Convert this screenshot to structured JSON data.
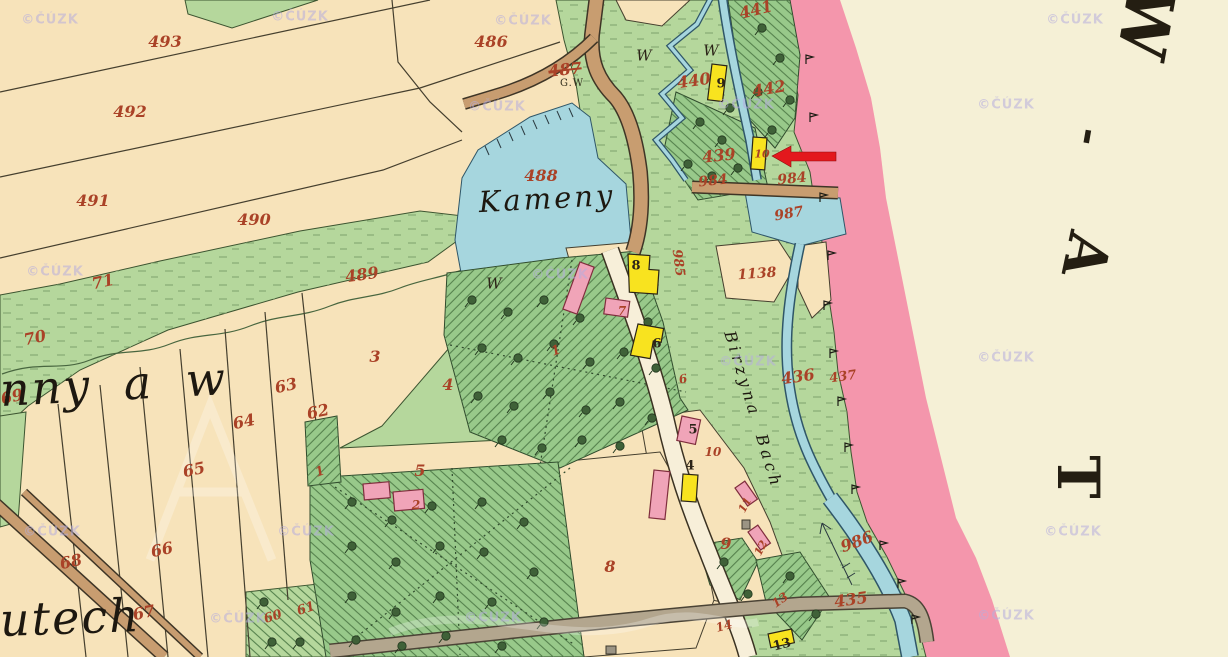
{
  "map": {
    "watermark_text": "©ČÚZK",
    "colors": {
      "field": "#f7e3ba",
      "paper": "#f5f0d6",
      "meadow": "#b5d79c",
      "forest": "#98c98a",
      "water": "#a6d6de",
      "wedge": "#2f5668",
      "pink": "#f496ac",
      "wood": "#f8e31f",
      "stone": "#f0a4b8",
      "red": "#aa4227",
      "wm": "#b6aede",
      "arrow": "#e3181d"
    },
    "labels": {
      "red": [
        {
          "t": "493",
          "x": 165,
          "y": 42
        },
        {
          "t": "492",
          "x": 130,
          "y": 112
        },
        {
          "t": "491",
          "x": 93,
          "y": 201
        },
        {
          "t": "490",
          "x": 254,
          "y": 220
        },
        {
          "t": "489",
          "x": 362,
          "y": 275,
          "r": -8
        },
        {
          "t": "71",
          "x": 103,
          "y": 282,
          "r": -12
        },
        {
          "t": "70",
          "x": 35,
          "y": 338,
          "r": -12
        },
        {
          "t": "69",
          "x": 12,
          "y": 397,
          "r": -12
        },
        {
          "t": "486",
          "x": 491,
          "y": 42
        },
        {
          "t": "487",
          "x": 565,
          "y": 70,
          "r": -6,
          "cls": "strike"
        },
        {
          "t": "488",
          "x": 541,
          "y": 176
        },
        {
          "t": "440",
          "x": 694,
          "y": 81,
          "r": -8
        },
        {
          "t": "441",
          "x": 756,
          "y": 10,
          "r": -14
        },
        {
          "t": "442",
          "x": 769,
          "y": 89,
          "r": -10
        },
        {
          "t": "439",
          "x": 719,
          "y": 156,
          "r": -6
        },
        {
          "t": "984",
          "x": 713,
          "y": 181,
          "r": -6,
          "s": 14
        },
        {
          "t": "984",
          "x": 792,
          "y": 179,
          "r": -6,
          "s": 14
        },
        {
          "t": "987",
          "x": 789,
          "y": 214,
          "r": -10,
          "s": 14
        },
        {
          "t": "1138",
          "x": 757,
          "y": 274,
          "r": -4,
          "s": 14
        },
        {
          "t": "985",
          "x": 678,
          "y": 263,
          "r": 82,
          "s": 13
        },
        {
          "t": "436",
          "x": 798,
          "y": 377,
          "r": -8
        },
        {
          "t": "437",
          "x": 843,
          "y": 377,
          "r": -8,
          "s": 13
        },
        {
          "t": "986",
          "x": 857,
          "y": 542,
          "r": -20
        },
        {
          "t": "435",
          "x": 851,
          "y": 600,
          "r": -8
        },
        {
          "t": "3",
          "x": 375,
          "y": 357
        },
        {
          "t": "4",
          "x": 448,
          "y": 385
        },
        {
          "t": "5",
          "x": 420,
          "y": 471
        },
        {
          "t": "63",
          "x": 286,
          "y": 386,
          "r": -12
        },
        {
          "t": "62",
          "x": 318,
          "y": 412,
          "r": -12
        },
        {
          "t": "64",
          "x": 244,
          "y": 422,
          "r": -12
        },
        {
          "t": "65",
          "x": 194,
          "y": 470,
          "r": -12
        },
        {
          "t": "66",
          "x": 162,
          "y": 550,
          "r": -12
        },
        {
          "t": "68",
          "x": 71,
          "y": 562,
          "r": -12
        },
        {
          "t": "67",
          "x": 144,
          "y": 613,
          "r": -12
        },
        {
          "t": "61",
          "x": 306,
          "y": 609,
          "r": -18,
          "s": 13
        },
        {
          "t": "60",
          "x": 273,
          "y": 617,
          "r": -18,
          "s": 13
        },
        {
          "t": "8",
          "x": 610,
          "y": 567
        },
        {
          "t": "9",
          "x": 726,
          "y": 544
        },
        {
          "t": "1",
          "x": 556,
          "y": 351,
          "r": -20,
          "s": 13
        },
        {
          "t": "1",
          "x": 320,
          "y": 472,
          "r": -20,
          "s": 13
        },
        {
          "t": "2",
          "x": 416,
          "y": 505,
          "s": 12
        },
        {
          "t": "7",
          "x": 622,
          "y": 311,
          "s": 12
        },
        {
          "t": "6",
          "x": 683,
          "y": 379,
          "r": -10,
          "s": 12
        },
        {
          "t": "10",
          "x": 762,
          "y": 154,
          "s": 11
        },
        {
          "t": "10",
          "x": 713,
          "y": 452,
          "s": 12
        },
        {
          "t": "11",
          "x": 745,
          "y": 505,
          "r": -62,
          "s": 11
        },
        {
          "t": "12",
          "x": 761,
          "y": 548,
          "r": -62,
          "s": 11
        },
        {
          "t": "13",
          "x": 780,
          "y": 600,
          "r": -35,
          "s": 12
        },
        {
          "t": "14",
          "x": 724,
          "y": 626,
          "r": -15,
          "s": 12
        }
      ],
      "black": [
        {
          "t": "9",
          "x": 721,
          "y": 84,
          "cls": "house",
          "n": "house-number"
        },
        {
          "t": "8",
          "x": 636,
          "y": 266,
          "cls": "house",
          "n": "house-number"
        },
        {
          "t": "6",
          "x": 657,
          "y": 344,
          "cls": "house",
          "n": "house-number"
        },
        {
          "t": "5",
          "x": 693,
          "y": 430,
          "cls": "house",
          "n": "house-number"
        },
        {
          "t": "4",
          "x": 690,
          "y": 466,
          "cls": "house",
          "n": "house-number"
        },
        {
          "t": "13",
          "x": 782,
          "y": 645,
          "r": -14,
          "cls": "house",
          "n": "house-number"
        },
        {
          "t": "W",
          "x": 644,
          "y": 56,
          "n": "meadow-mark"
        },
        {
          "t": "W",
          "x": 711,
          "y": 51,
          "n": "meadow-mark"
        },
        {
          "t": "W",
          "x": 494,
          "y": 284,
          "n": "meadow-mark"
        },
        {
          "t": "G.W",
          "x": 572,
          "y": 84,
          "cls": "gw",
          "n": "culture-abbr"
        },
        {
          "t": "Kameny",
          "x": 547,
          "y": 199,
          "r": -3,
          "cls": "pond-name",
          "n": "pond-label"
        },
        {
          "t": "Birzyna Bach",
          "x": 753,
          "y": 410,
          "r": 73,
          "cls": "stream-name",
          "n": "stream-label"
        },
        {
          "t": "nny a w",
          "x": 0,
          "y": 390,
          "r": -3,
          "cls": "bigscript",
          "n": "territory-script"
        },
        {
          "t": "utech",
          "x": 0,
          "y": 620,
          "r": -2,
          "cls": "bigscript",
          "n": "territory-script"
        }
      ],
      "margin": [
        {
          "t": "W",
          "x": 1146,
          "y": 22,
          "r": 100,
          "s": 66
        },
        {
          "t": "-",
          "x": 1090,
          "y": 137,
          "r": 100,
          "s": 42
        },
        {
          "t": "A",
          "x": 1086,
          "y": 255,
          "r": 102,
          "s": 58
        },
        {
          "t": "T",
          "x": 1078,
          "y": 477,
          "r": 90,
          "s": 58
        }
      ],
      "watermarks": [
        {
          "x": 50,
          "y": 20
        },
        {
          "x": 300,
          "y": 17
        },
        {
          "x": 523,
          "y": 21
        },
        {
          "x": 1075,
          "y": 20
        },
        {
          "x": 746,
          "y": 105
        },
        {
          "x": 497,
          "y": 107
        },
        {
          "x": 1006,
          "y": 105
        },
        {
          "x": 560,
          "y": 275
        },
        {
          "x": 55,
          "y": 272
        },
        {
          "x": 748,
          "y": 362
        },
        {
          "x": 1006,
          "y": 358
        },
        {
          "x": 52,
          "y": 532
        },
        {
          "x": 306,
          "y": 532
        },
        {
          "x": 1073,
          "y": 532
        },
        {
          "x": 238,
          "y": 619
        },
        {
          "x": 493,
          "y": 618
        },
        {
          "x": 1006,
          "y": 616
        }
      ]
    }
  }
}
